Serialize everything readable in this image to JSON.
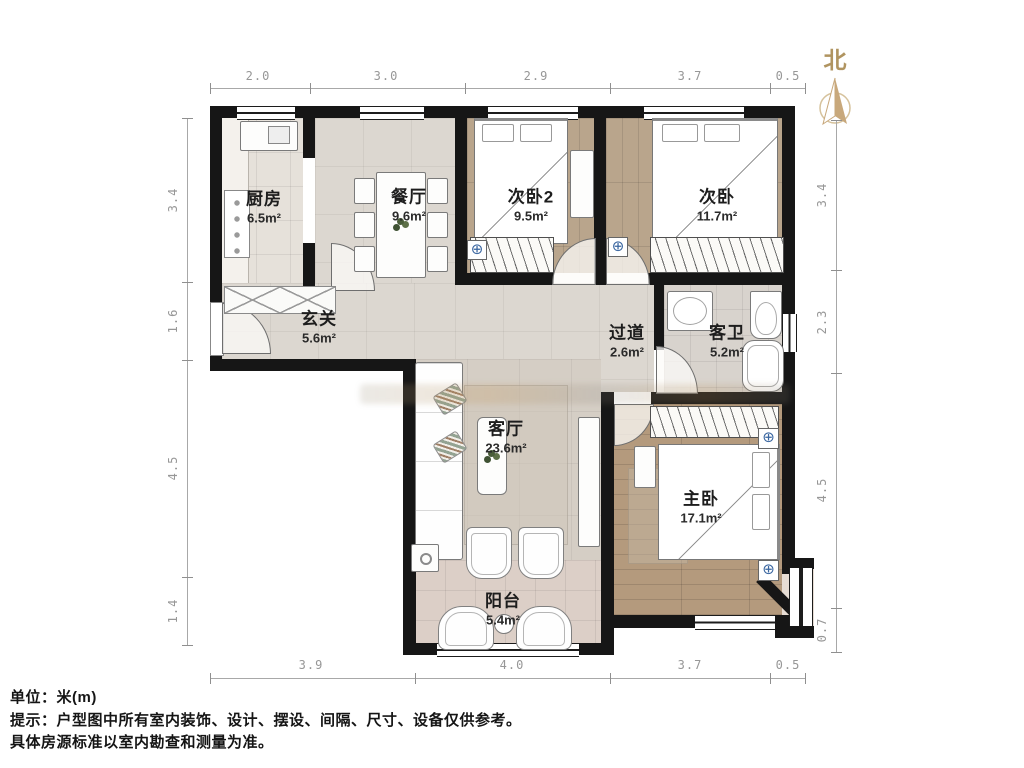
{
  "north_label": "北",
  "rooms": [
    {
      "id": "kitchen",
      "name": "厨房",
      "area": "6.5m²"
    },
    {
      "id": "dining",
      "name": "餐厅",
      "area": "9.6m²"
    },
    {
      "id": "bedroom2",
      "name": "次卧2",
      "area": "9.5m²"
    },
    {
      "id": "bedroom",
      "name": "次卧",
      "area": "11.7m²"
    },
    {
      "id": "hall",
      "name": "玄关",
      "area": "5.6m²"
    },
    {
      "id": "corridor",
      "name": "过道",
      "area": "2.6m²"
    },
    {
      "id": "bath",
      "name": "客卫",
      "area": "5.2m²"
    },
    {
      "id": "living",
      "name": "客厅",
      "area": "23.6m²"
    },
    {
      "id": "master",
      "name": "主卧",
      "area": "17.1m²"
    },
    {
      "id": "balcony",
      "name": "阳台",
      "area": "5.4m²"
    }
  ],
  "dimensions": {
    "top": [
      "2.0",
      "3.0",
      "2.9",
      "3.7",
      "0.5"
    ],
    "bottom": [
      "3.9",
      "4.0",
      "3.7",
      "0.5"
    ],
    "left": [
      "3.4",
      "1.6",
      "4.5",
      "1.4"
    ],
    "right": [
      "3.4",
      "2.3",
      "4.5",
      "0.7"
    ]
  },
  "footer": {
    "unit": "单位：米(m)",
    "tip": "提示：户型图中所有室内装饰、设计、摆设、间隔、尺寸、设备仅供参考。",
    "note": "具体房源标准以室内勘查和测量为准。"
  },
  "colors": {
    "wall": "#161616",
    "compass": "#c8a87b",
    "dimension_text": "#979797",
    "wood_floor": "#b49a7d",
    "radiator_icon": "#3a66a0"
  }
}
